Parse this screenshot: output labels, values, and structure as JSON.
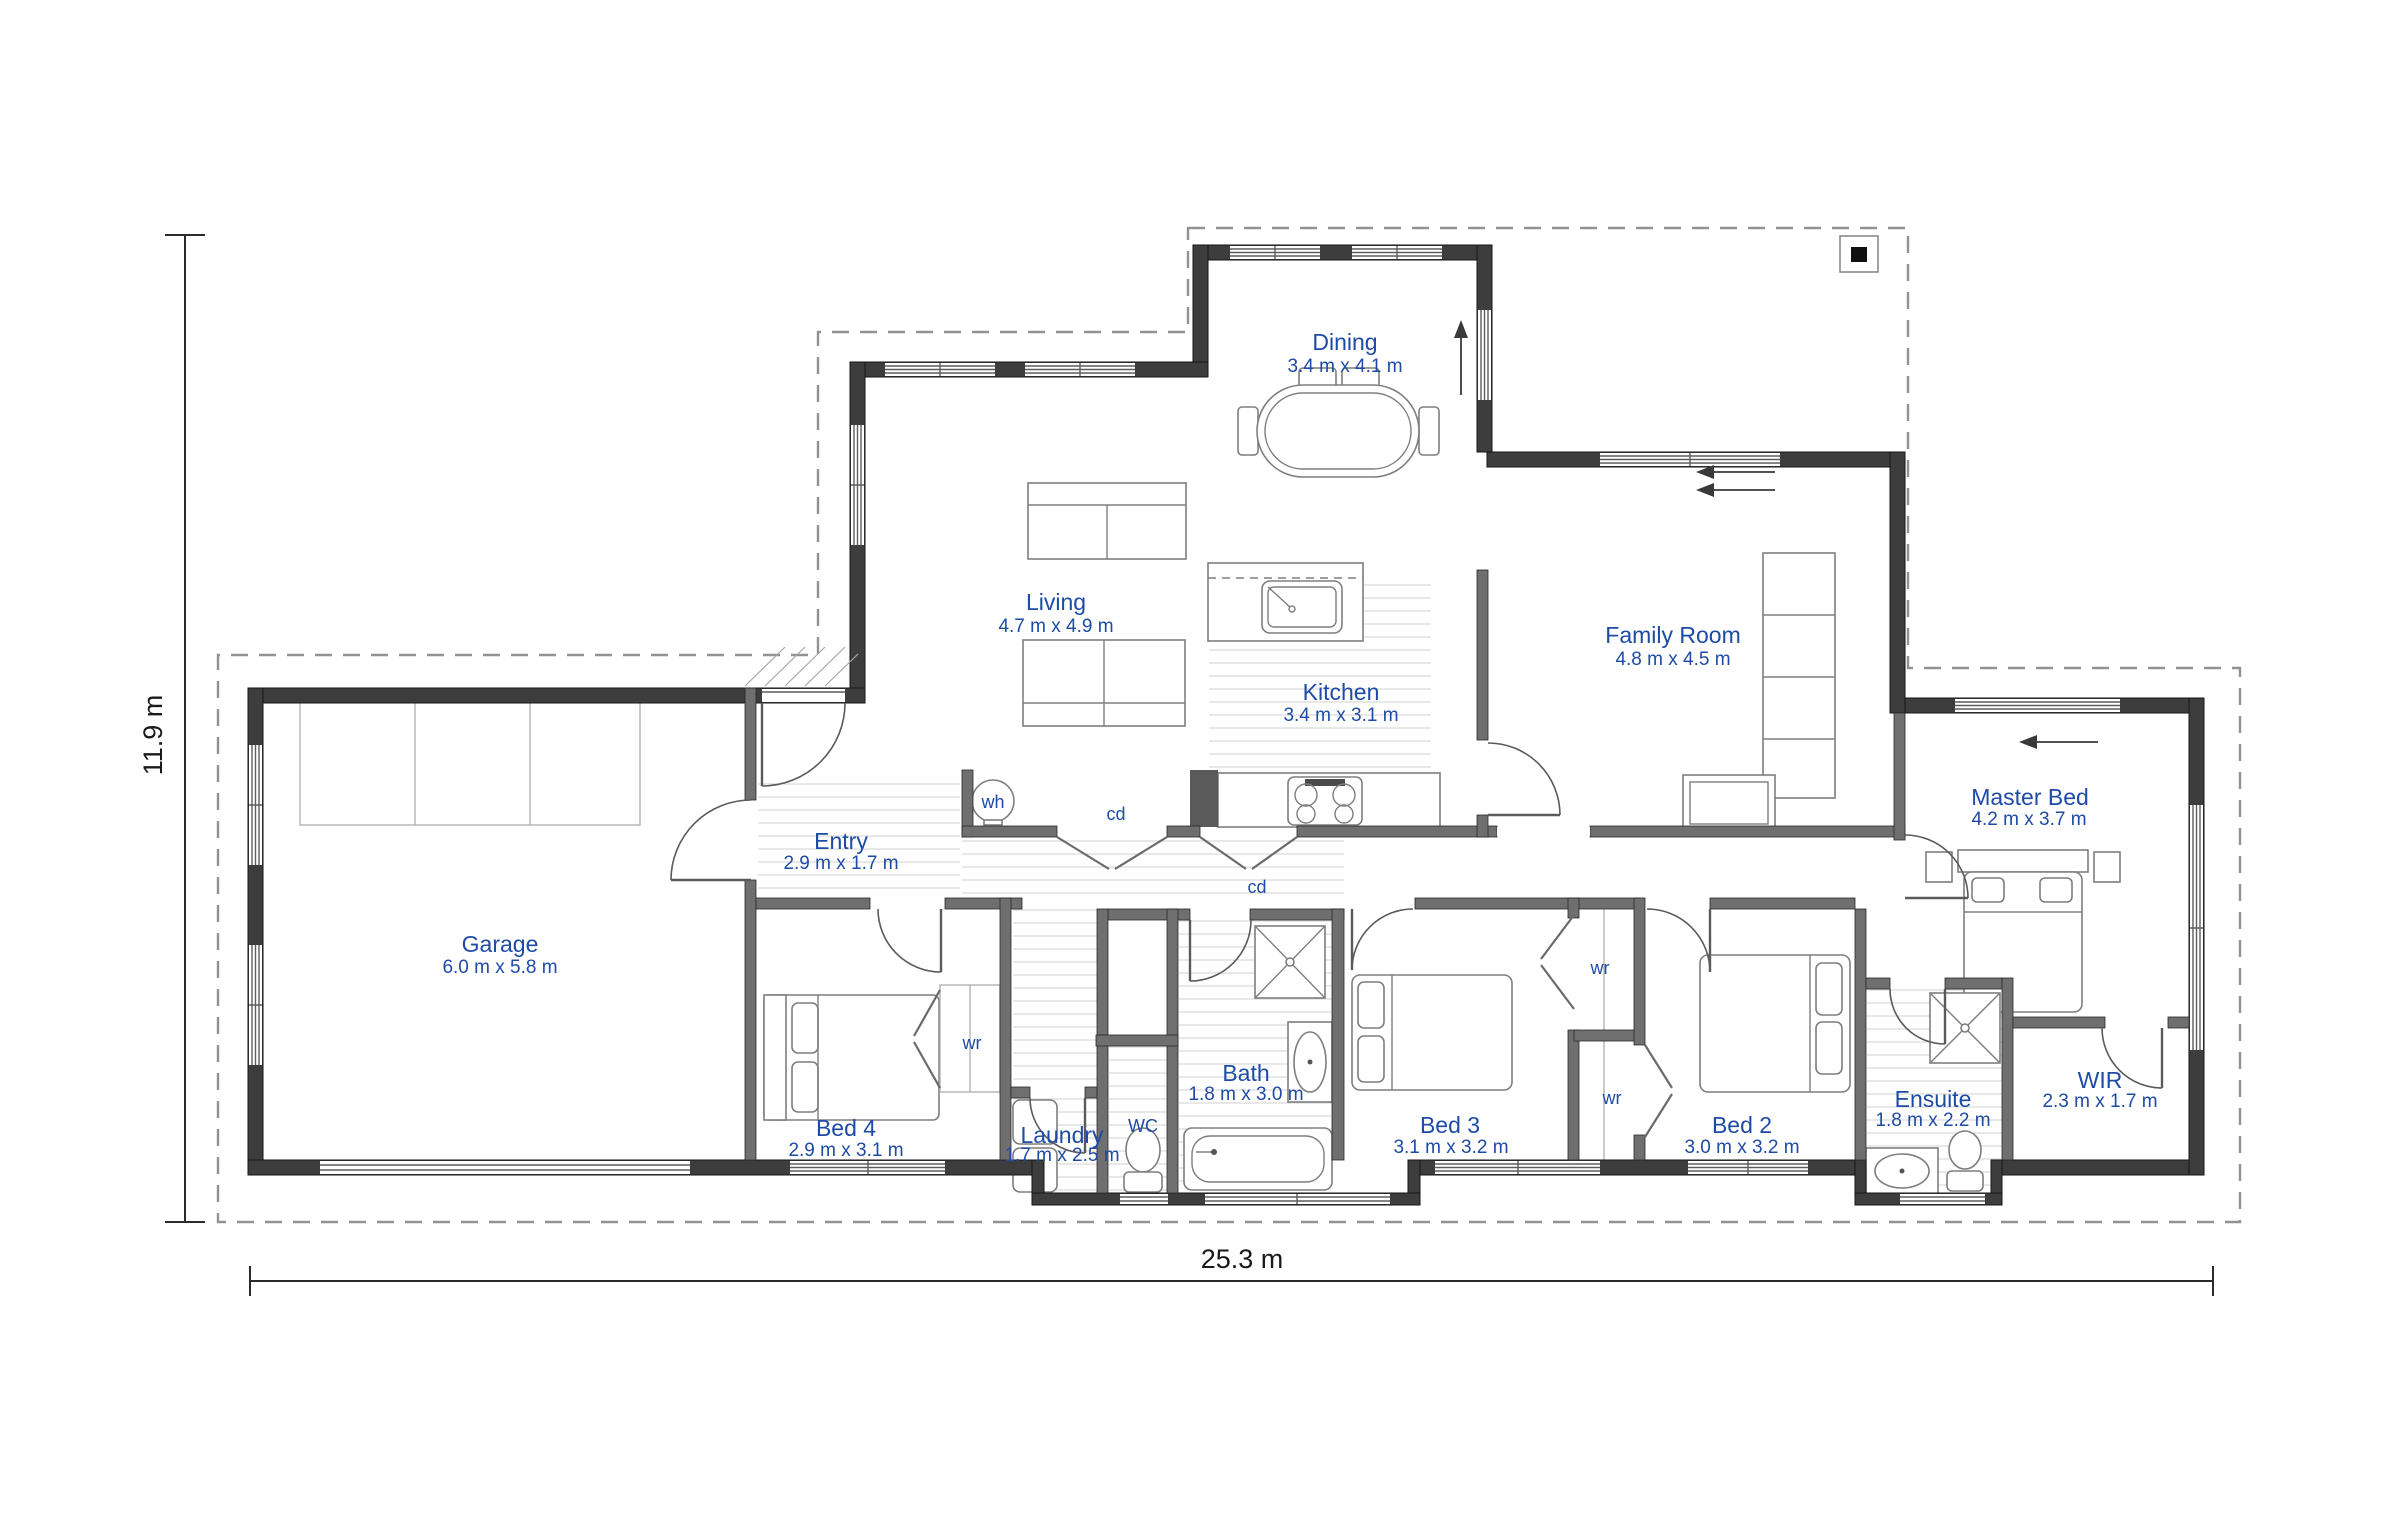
{
  "plan": {
    "label_color": "#1d4ba5",
    "overall_dimensions": {
      "width": "25.3 m",
      "height": "11.9 m"
    },
    "rooms": [
      {
        "name": "Dining",
        "dims": "3.4 m x 4.1 m"
      },
      {
        "name": "Living",
        "dims": "4.7 m x 4.9 m"
      },
      {
        "name": "Kitchen",
        "dims": "3.4 m x 3.1 m"
      },
      {
        "name": "Family Room",
        "dims": "4.8 m x 4.5 m"
      },
      {
        "name": "Master Bed",
        "dims": "4.2 m x 3.7 m"
      },
      {
        "name": "Entry",
        "dims": "2.9 m x 1.7 m"
      },
      {
        "name": "Garage",
        "dims": "6.0 m x 5.8 m"
      },
      {
        "name": "Bed 4",
        "dims": "2.9 m x 3.1 m"
      },
      {
        "name": "Laundry",
        "dims": "1.7 m x 2.5 m"
      },
      {
        "name": "Bath",
        "dims": "1.8 m x 3.0 m"
      },
      {
        "name": "Bed 3",
        "dims": "3.1 m x 3.2 m"
      },
      {
        "name": "Bed 2",
        "dims": "3.0 m x 3.2 m"
      },
      {
        "name": "Ensuite",
        "dims": "1.8 m x 2.2 m"
      },
      {
        "name": "WIR",
        "dims": "2.3 m x 1.7 m"
      },
      {
        "name": "WC",
        "dims": ""
      }
    ],
    "fixture_labels": {
      "water_heater": "wh",
      "cupboard": "cd",
      "wardrobe": "wr"
    }
  }
}
